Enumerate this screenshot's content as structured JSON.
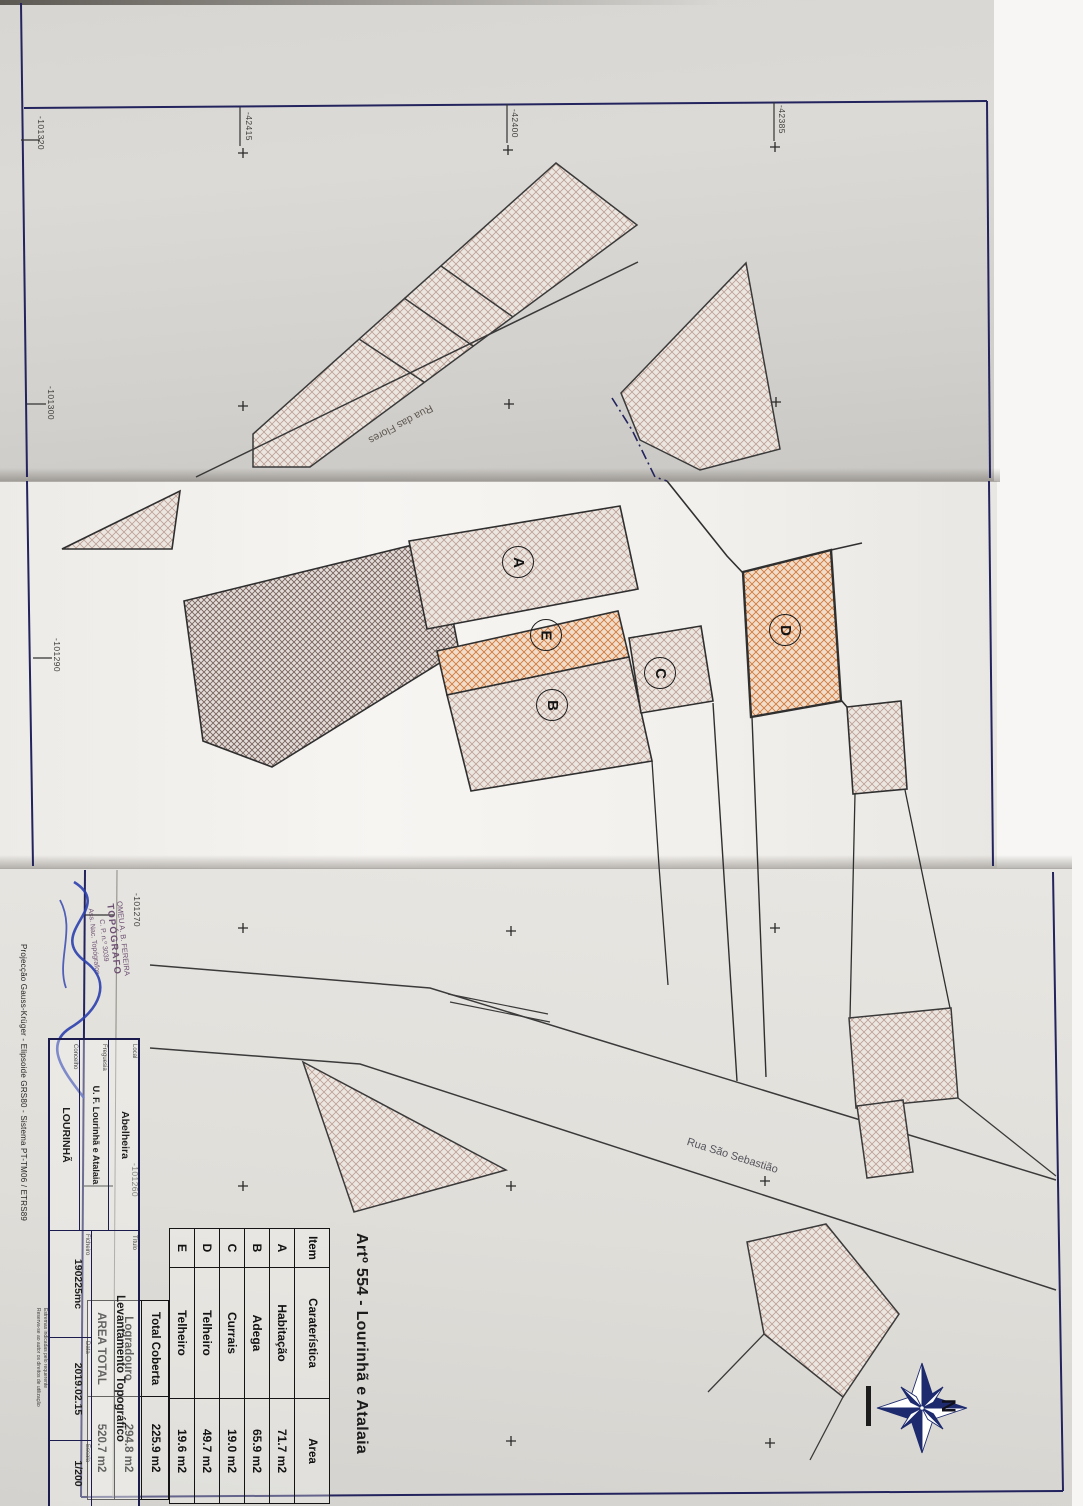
{
  "document": {
    "sheet_title": "Artº 554 - Lourinhã e Atalaia"
  },
  "title_block": {
    "fields": {
      "local": {
        "label": "Local",
        "value": "Abelheira"
      },
      "freguesia": {
        "label": "Freguesia",
        "value": "U. F. Lourinhã e Atalaia"
      },
      "concelho": {
        "label": "Concelho",
        "value": "LOURINHÃ"
      },
      "titulo": {
        "label": "Título",
        "value": "Levantamento Topográfico"
      },
      "ficheiro": {
        "label": "Ficheiro",
        "value": "190225mc"
      },
      "data": {
        "label": "Data",
        "value": "2019.02.15"
      },
      "escala": {
        "label": "Escala",
        "value": "1/200"
      }
    },
    "projection": "Projecção Gauss-Krüger - Elipsoide GRS80 - Sistema PT-TM06 / ETRS89",
    "notes": [
      "Estremas indicadas pelo requerente",
      "Reserva-se ao autor os direitos de utilização"
    ],
    "stamp": {
      "line1": "OMEU A. B. FEREIRA",
      "line2": "TOPÓGRAFO",
      "line3": "C. P. n.º 3039",
      "line4": "Ass. Nac. Topógrafos"
    }
  },
  "area_table": {
    "headers": {
      "item": "Item",
      "caracteristica": "Caraterística",
      "area": "Area"
    },
    "rows": [
      {
        "item": "A",
        "caracteristica": "Habitação",
        "area": "71.7 m2"
      },
      {
        "item": "B",
        "caracteristica": "Adega",
        "area": "65.9 m2"
      },
      {
        "item": "C",
        "caracteristica": "Currais",
        "area": "19.0 m2"
      },
      {
        "item": "D",
        "caracteristica": "Telheiro",
        "area": "49.7 m2"
      },
      {
        "item": "E",
        "caracteristica": "Telheiro",
        "area": "19.6 m2"
      }
    ],
    "totals": [
      {
        "label": "Total Coberta",
        "area": "225.9 m2"
      },
      {
        "label": "Logradouro",
        "area": "294.8 m2"
      },
      {
        "label": "AREA TOTAL",
        "area": "520.7 m2"
      }
    ]
  },
  "plan": {
    "streets": {
      "rua_das_flores": "Rua das Flores",
      "rua_sao_sebastiao": "Rua São Sebastião"
    },
    "building_labels": [
      "A",
      "E",
      "B",
      "C",
      "D"
    ],
    "compass_north": "N"
  },
  "coordinates": {
    "top_ticks": [
      "-42415",
      "-42400",
      "-42385"
    ],
    "left_ticks": [
      "-101320",
      "-101300",
      "-101290"
    ],
    "lower_left_ticks": [
      "-101270",
      "-101260"
    ]
  },
  "colors": {
    "frame_navy": "#23235e",
    "hatch_grey": "#96645a",
    "hatch_orange": "#cd6e2d",
    "signature_blue": "#2b3fae",
    "paper_grey": "#d8d6d2"
  }
}
